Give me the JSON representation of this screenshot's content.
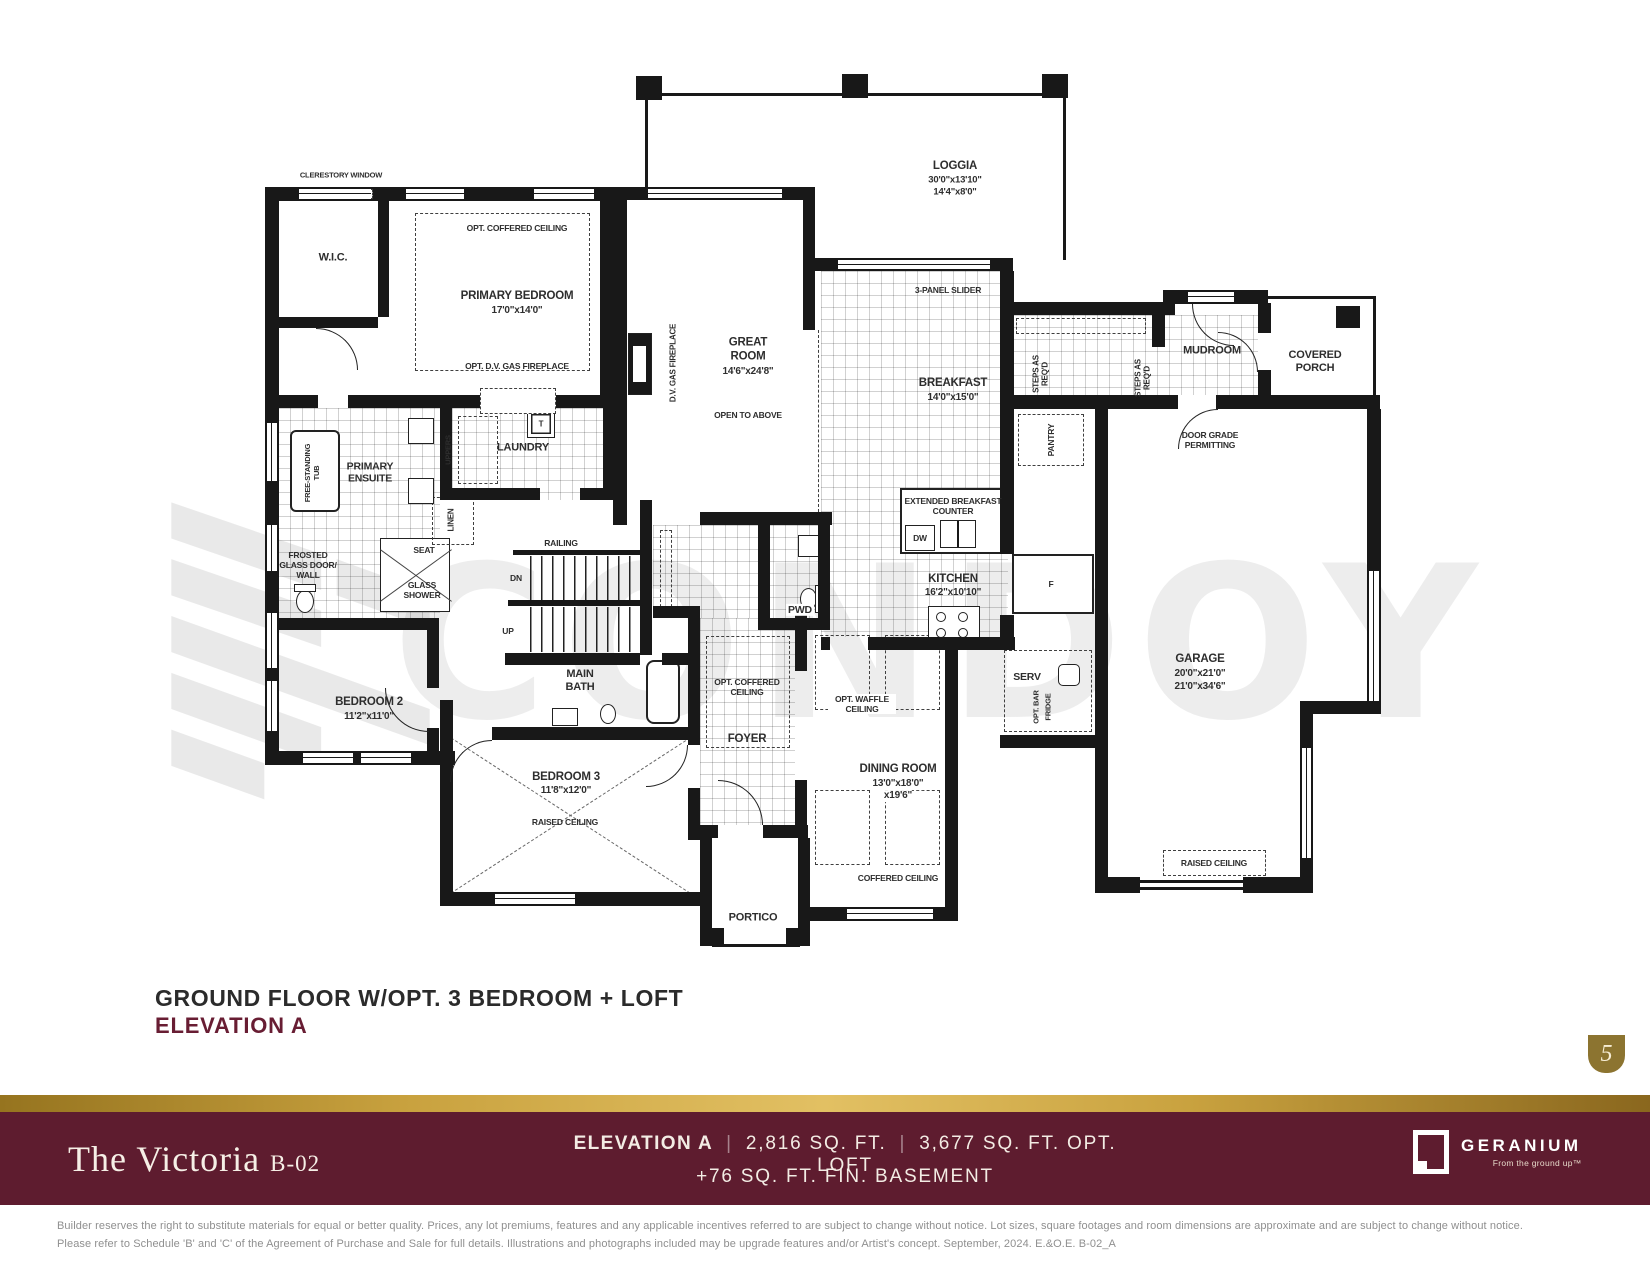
{
  "watermark": {
    "text": "CONDOY"
  },
  "plan": {
    "labels": {
      "clerestory": "CLERESTORY WINDOW",
      "wic": "W.I.C.",
      "primary_ceiling": "OPT. COFFERED CEILING",
      "primary_name": "PRIMARY BEDROOM",
      "primary_dims": "17'0\"x14'0\"",
      "primary_fireplace": "OPT. D.V. GAS FIREPLACE",
      "loggia_name": "LOGGIA",
      "loggia_dims1": "30'0\"x13'10\"",
      "loggia_dims2": "14'4\"x8'0\"",
      "slider": "3-PANEL SLIDER",
      "great_name": "GREAT ROOM",
      "great_dims": "14'6\"x24'8\"",
      "open_above": "OPEN TO ABOVE",
      "dv_fireplace": "D.V. GAS FIREPLACE",
      "breakfast_name": "BREAKFAST",
      "breakfast_dims": "14'0\"x15'0\"",
      "steps1": "STEPS AS REQ'D",
      "steps2": "STEPS AS REQ'D",
      "mudroom": "MUDROOM",
      "covered_porch": "COVERED PORCH",
      "door_grade": "DOOR GRADE PERMITTING",
      "pantry": "PANTRY",
      "laundry": "LAUNDRY",
      "t": "T",
      "uppers": "UPPERS",
      "ensuite": "PRIMARY ENSUITE",
      "tub": "FREE-STANDING TUB",
      "frosted": "FROSTED GLASS DOOR/ WALL",
      "seat": "SEAT",
      "shower": "GLASS SHOWER",
      "linen": "LINEN",
      "ext_counter": "EXTENDED BREAKFAST COUNTER",
      "dw": "DW",
      "kitchen_name": "KITCHEN",
      "kitchen_dims": "16'2\"x10'10\"",
      "f": "F",
      "serv": "SERV",
      "opt_bar": "OPT. BAR",
      "fridge": "FRIDGE",
      "railing": "RAILING",
      "dn": "DN",
      "up": "UP",
      "main_bath": "MAIN BATH",
      "bedroom2_name": "BEDROOM 2",
      "bedroom2_dims": "11'2\"x11'0\"",
      "bedroom3_name": "BEDROOM 3",
      "bedroom3_dims": "11'8\"x12'0\"",
      "raised_ceiling_b3": "RAISED CEILING",
      "pwd": "PWD",
      "foyer_ceiling": "OPT. COFFERED CEILING",
      "foyer": "FOYER",
      "waffle_ceiling": "OPT. WAFFLE CEILING",
      "dining_name": "DINING ROOM",
      "dining_dims1": "13'0\"x18'0\"",
      "dining_dims2": "x19'6\"",
      "coffered_dining": "COFFERED CEILING",
      "portico": "PORTICO",
      "garage_name": "GARAGE",
      "garage_dims1": "20'0\"x21'0\"",
      "garage_dims2": "21'0\"x34'6\"",
      "raised_ceiling_garage": "RAISED CEILING"
    }
  },
  "title": {
    "line1": "GROUND FLOOR W/OPT. 3 BEDROOM + LOFT",
    "line2": "ELEVATION A"
  },
  "page_badge": "5",
  "footer": {
    "model_name": "The Victoria",
    "model_code": "B-02",
    "elevation": "ELEVATION A",
    "separator": "|",
    "sqft": "2,816 SQ. FT.",
    "sqft_loft": "3,677 SQ. FT. OPT. LOFT",
    "basement": "+76 SQ. FT. FIN. BASEMENT",
    "brand": "GERANIUM",
    "tagline": "From the ground up™"
  },
  "disclaimer": {
    "line1": "Builder reserves the right to substitute materials for equal or better quality. Prices, any lot premiums, features and any applicable incentives referred to are subject to change without notice. Lot sizes, square footages and room dimensions are approximate and are subject to change without notice.",
    "line2": "Please refer to Schedule 'B' and 'C' of the Agreement of Purchase and Sale for full details. Illustrations and photographs included may be upgrade features and/or Artist's concept. September, 2024. E.&O.E. B-02_A"
  },
  "colors": {
    "maroon": "#5e1c2f",
    "gold": "#c9a23f",
    "badge_gold": "#8c7430",
    "title_accent": "#681d33"
  }
}
